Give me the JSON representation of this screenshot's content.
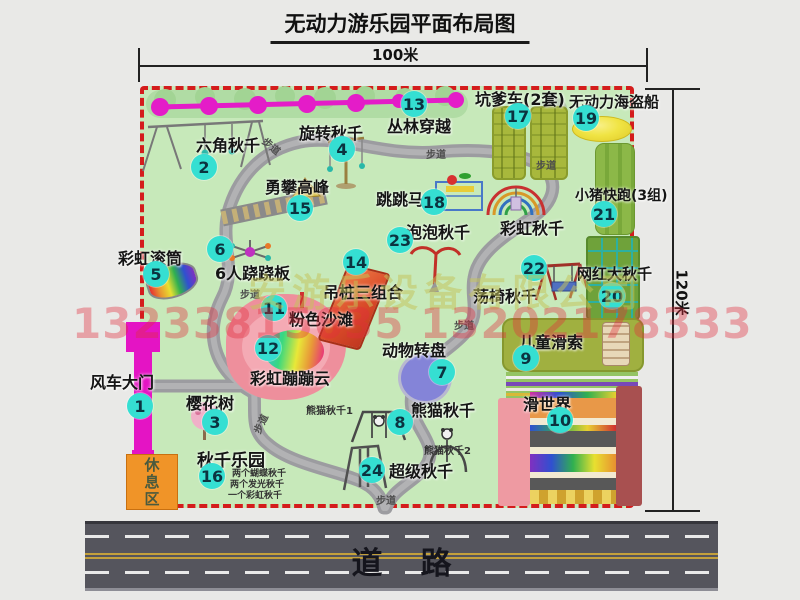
{
  "title": "无动力游乐园平面布局图",
  "dimensions": {
    "width_label": "100米",
    "height_label": "120米"
  },
  "road": {
    "label": "道路"
  },
  "watermarks": {
    "phone": "13233815635 13202178333",
    "company": "安游乐设备有限公司"
  },
  "labels": {
    "path": "步道",
    "rest_area": "休息区",
    "rainbow_swing": "彩虹秋千",
    "panda_swing_1": "熊猫秋千1",
    "panda_swing_2": "熊猫秋千2"
  },
  "swing_park_notes": [
    "两个蝴蝶秋千",
    "两个发光秋千",
    "一个彩虹秋千"
  ],
  "attractions": [
    {
      "num": "1",
      "label": "风车大门"
    },
    {
      "num": "2",
      "label": "六角秋千"
    },
    {
      "num": "3",
      "label": "樱花树"
    },
    {
      "num": "4",
      "label": "旋转秋千"
    },
    {
      "num": "5",
      "label": "彩虹滚筒"
    },
    {
      "num": "6",
      "label": "6人跷跷板"
    },
    {
      "num": "7",
      "label": "动物转盘"
    },
    {
      "num": "8",
      "label": "熊猫秋千"
    },
    {
      "num": "9",
      "label": "儿童滑索"
    },
    {
      "num": "10",
      "label": "滑世界"
    },
    {
      "num": "11",
      "label": "粉色沙滩"
    },
    {
      "num": "12",
      "label": "彩虹蹦蹦云"
    },
    {
      "num": "13",
      "label": "丛林穿越"
    },
    {
      "num": "14",
      "label": "吊桩三组合"
    },
    {
      "num": "15",
      "label": "勇攀高峰"
    },
    {
      "num": "16",
      "label": "秋千乐园"
    },
    {
      "num": "17",
      "label": "坑爹车(2套)"
    },
    {
      "num": "18",
      "label": "跳跳马"
    },
    {
      "num": "19",
      "label": "无动力海盗船"
    },
    {
      "num": "20",
      "label": "网红大秋千"
    },
    {
      "num": "21",
      "label": "小猪快跑(3组)"
    },
    {
      "num": "22",
      "label": "荡椅秋千"
    },
    {
      "num": "23",
      "label": "泡泡秋千"
    },
    {
      "num": "24",
      "label": "超级秋千"
    }
  ],
  "colors": {
    "map_green": "#c7e9ba",
    "border_red": "#d41c1c",
    "badge_teal": "#35dfd2",
    "zipline_magenta": "#e41cc8",
    "path_gray": "#9c9ca0",
    "road_gray": "#55555d"
  }
}
